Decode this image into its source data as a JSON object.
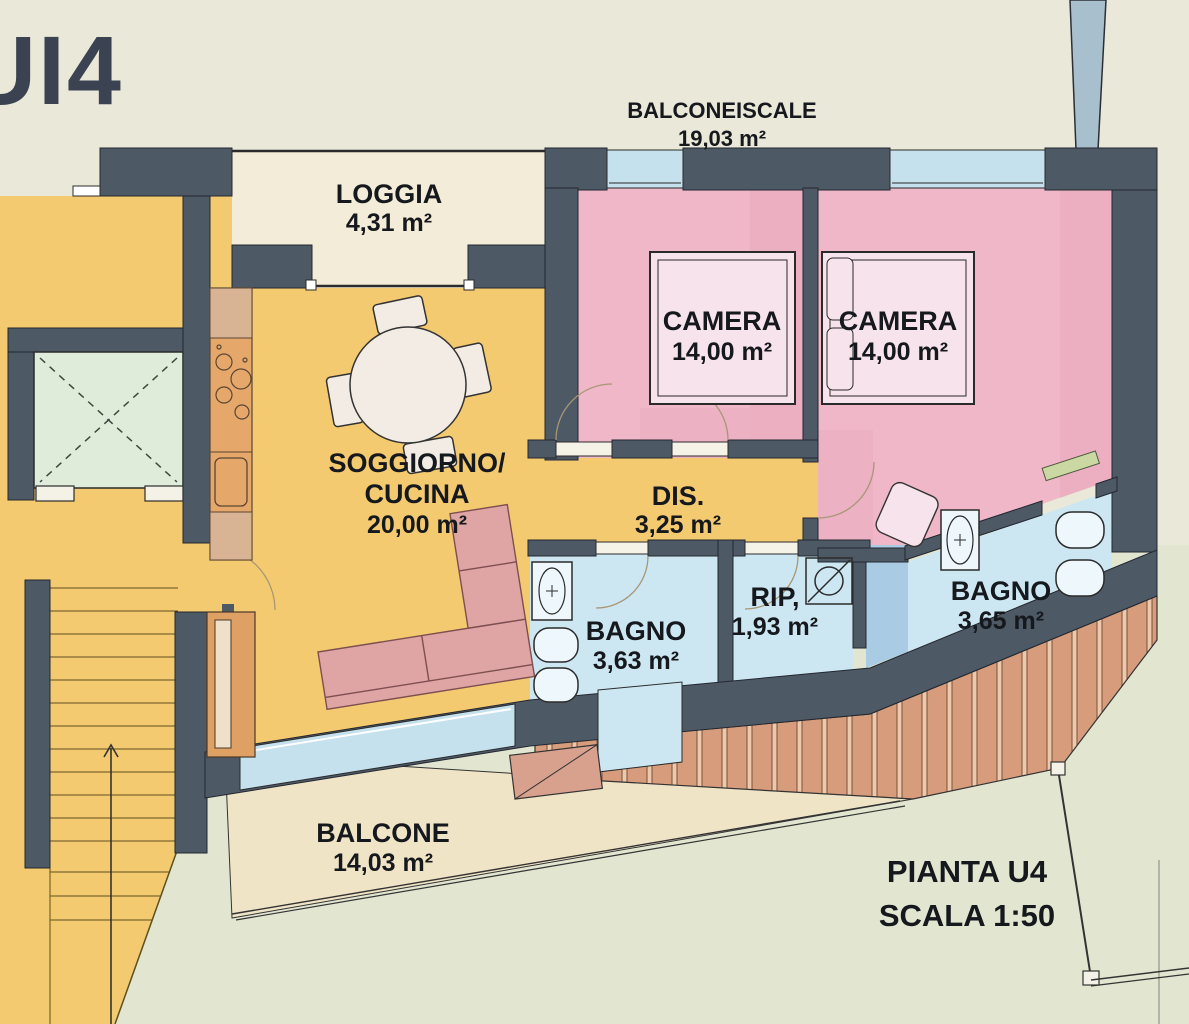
{
  "title": "UI4",
  "footer": {
    "plan_title": "PIANTA U4",
    "plan_scale": "SCALA 1:50"
  },
  "rooms": [
    {
      "id": "balcone-scale",
      "name": "BALCONEISCALE",
      "area": "19,03 m²"
    },
    {
      "id": "loggia",
      "name": "LOGGIA",
      "area": "4,31 m²"
    },
    {
      "id": "camera-1",
      "name": "CAMERA",
      "area": "14,00 m²"
    },
    {
      "id": "camera-2",
      "name": "CAMERA",
      "area": "14,00 m²"
    },
    {
      "id": "soggiorno-cucina",
      "name": "SOGGIORNO/",
      "name_line2": "CUCINA",
      "area": "20,00 m²"
    },
    {
      "id": "disimpegno",
      "name": "DIS.",
      "area": "3,25 m²"
    },
    {
      "id": "bagno-1",
      "name": "BAGNO",
      "area": "3,63 m²"
    },
    {
      "id": "ripostiglio",
      "name": "RIP,",
      "area": "1,93 m²"
    },
    {
      "id": "bagno-2",
      "name": "BAGNO",
      "area": "3,65 m²"
    },
    {
      "id": "balcone",
      "name": "BALCONE",
      "area": "14,03 m²"
    }
  ],
  "symbols": [
    "elevator-shaft",
    "staircase",
    "dining-table",
    "chairs",
    "corner-sofa",
    "double-bed",
    "kitchen-counter",
    "hob",
    "kitchen-sink",
    "wardrobe",
    "washbasin",
    "toilet",
    "bidet",
    "shower-box",
    "planter-box",
    "wood-deck",
    "railing",
    "downpipe",
    "window",
    "door-swing"
  ],
  "colors": {
    "wall": "#4e5966",
    "background": "#eae8d8",
    "background_lower": "#e2e6d0",
    "floor_yellow": "#f4ca70",
    "floor_pink": "#efb7c7",
    "floor_pink_shade": "#e9a8bc",
    "bed_pink": "#f7e3eb",
    "floor_blue": "#cde7f2",
    "floor_blue_medium": "#a9cbe4",
    "window_blue": "#c5e1ee",
    "loggia_cream": "#f3ecd8",
    "balcony_cream": "#f0e4c7",
    "elevator_green": "#dfecd9",
    "deck_wood": "#d69c7b",
    "counter_orange": "#e6a76b",
    "wardrobe_orange": "#dfa063",
    "sofa_pink": "#dfa4a4",
    "door_green": "#ccd8a4",
    "text": "#15181c"
  }
}
